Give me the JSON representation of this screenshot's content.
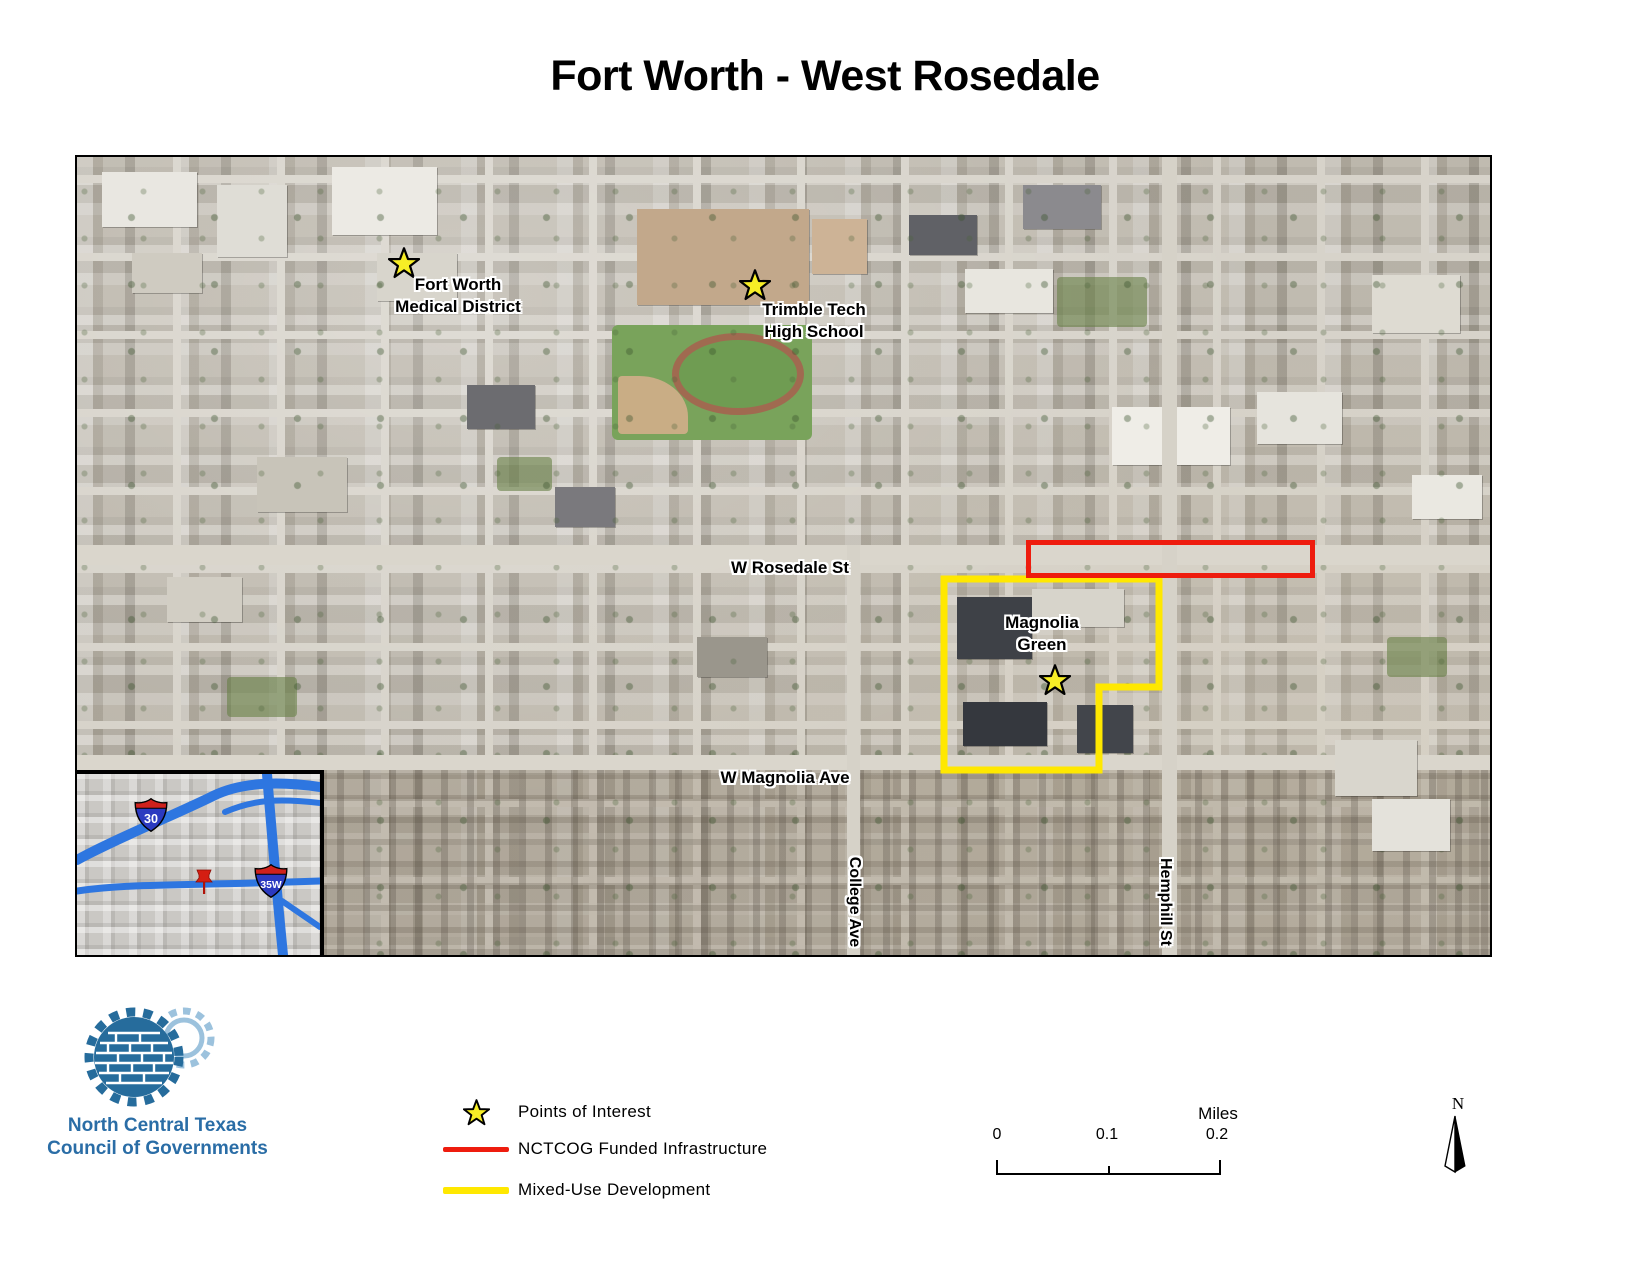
{
  "title": "Fort Worth - West Rosedale",
  "map": {
    "poi_fort_worth_medical": {
      "line1": "Fort Worth",
      "line2": "Medical District"
    },
    "poi_trimble_tech": {
      "line1": "Trimble Tech",
      "line2": "High School"
    },
    "poi_magnolia_green": {
      "line1": "Magnolia",
      "line2": "Green"
    },
    "streets": {
      "rosedale": "W Rosedale St",
      "magnolia": "W Magnolia Ave",
      "college": "College Ave",
      "hemphill": "Hemphill St"
    },
    "overlay_colors": {
      "funded_infrastructure": "#ee1c0e",
      "mixed_use": "#ffe800",
      "poi_star": "#f7ee26"
    }
  },
  "inset": {
    "shield_30": "30",
    "shield_35w": "35W"
  },
  "legend": {
    "poi_label": "Points of Interest",
    "funded_label": "NCTCOG Funded Infrastructure",
    "mixed_label": "Mixed-Use Development"
  },
  "scalebar": {
    "tick0": "0",
    "tick1": "0.1",
    "tick2": "0.2",
    "unit": "Miles"
  },
  "north_arrow": {
    "label": "N"
  },
  "logo": {
    "line1": "North Central Texas",
    "line2": "Council of Governments",
    "color": "#2a6da6"
  }
}
